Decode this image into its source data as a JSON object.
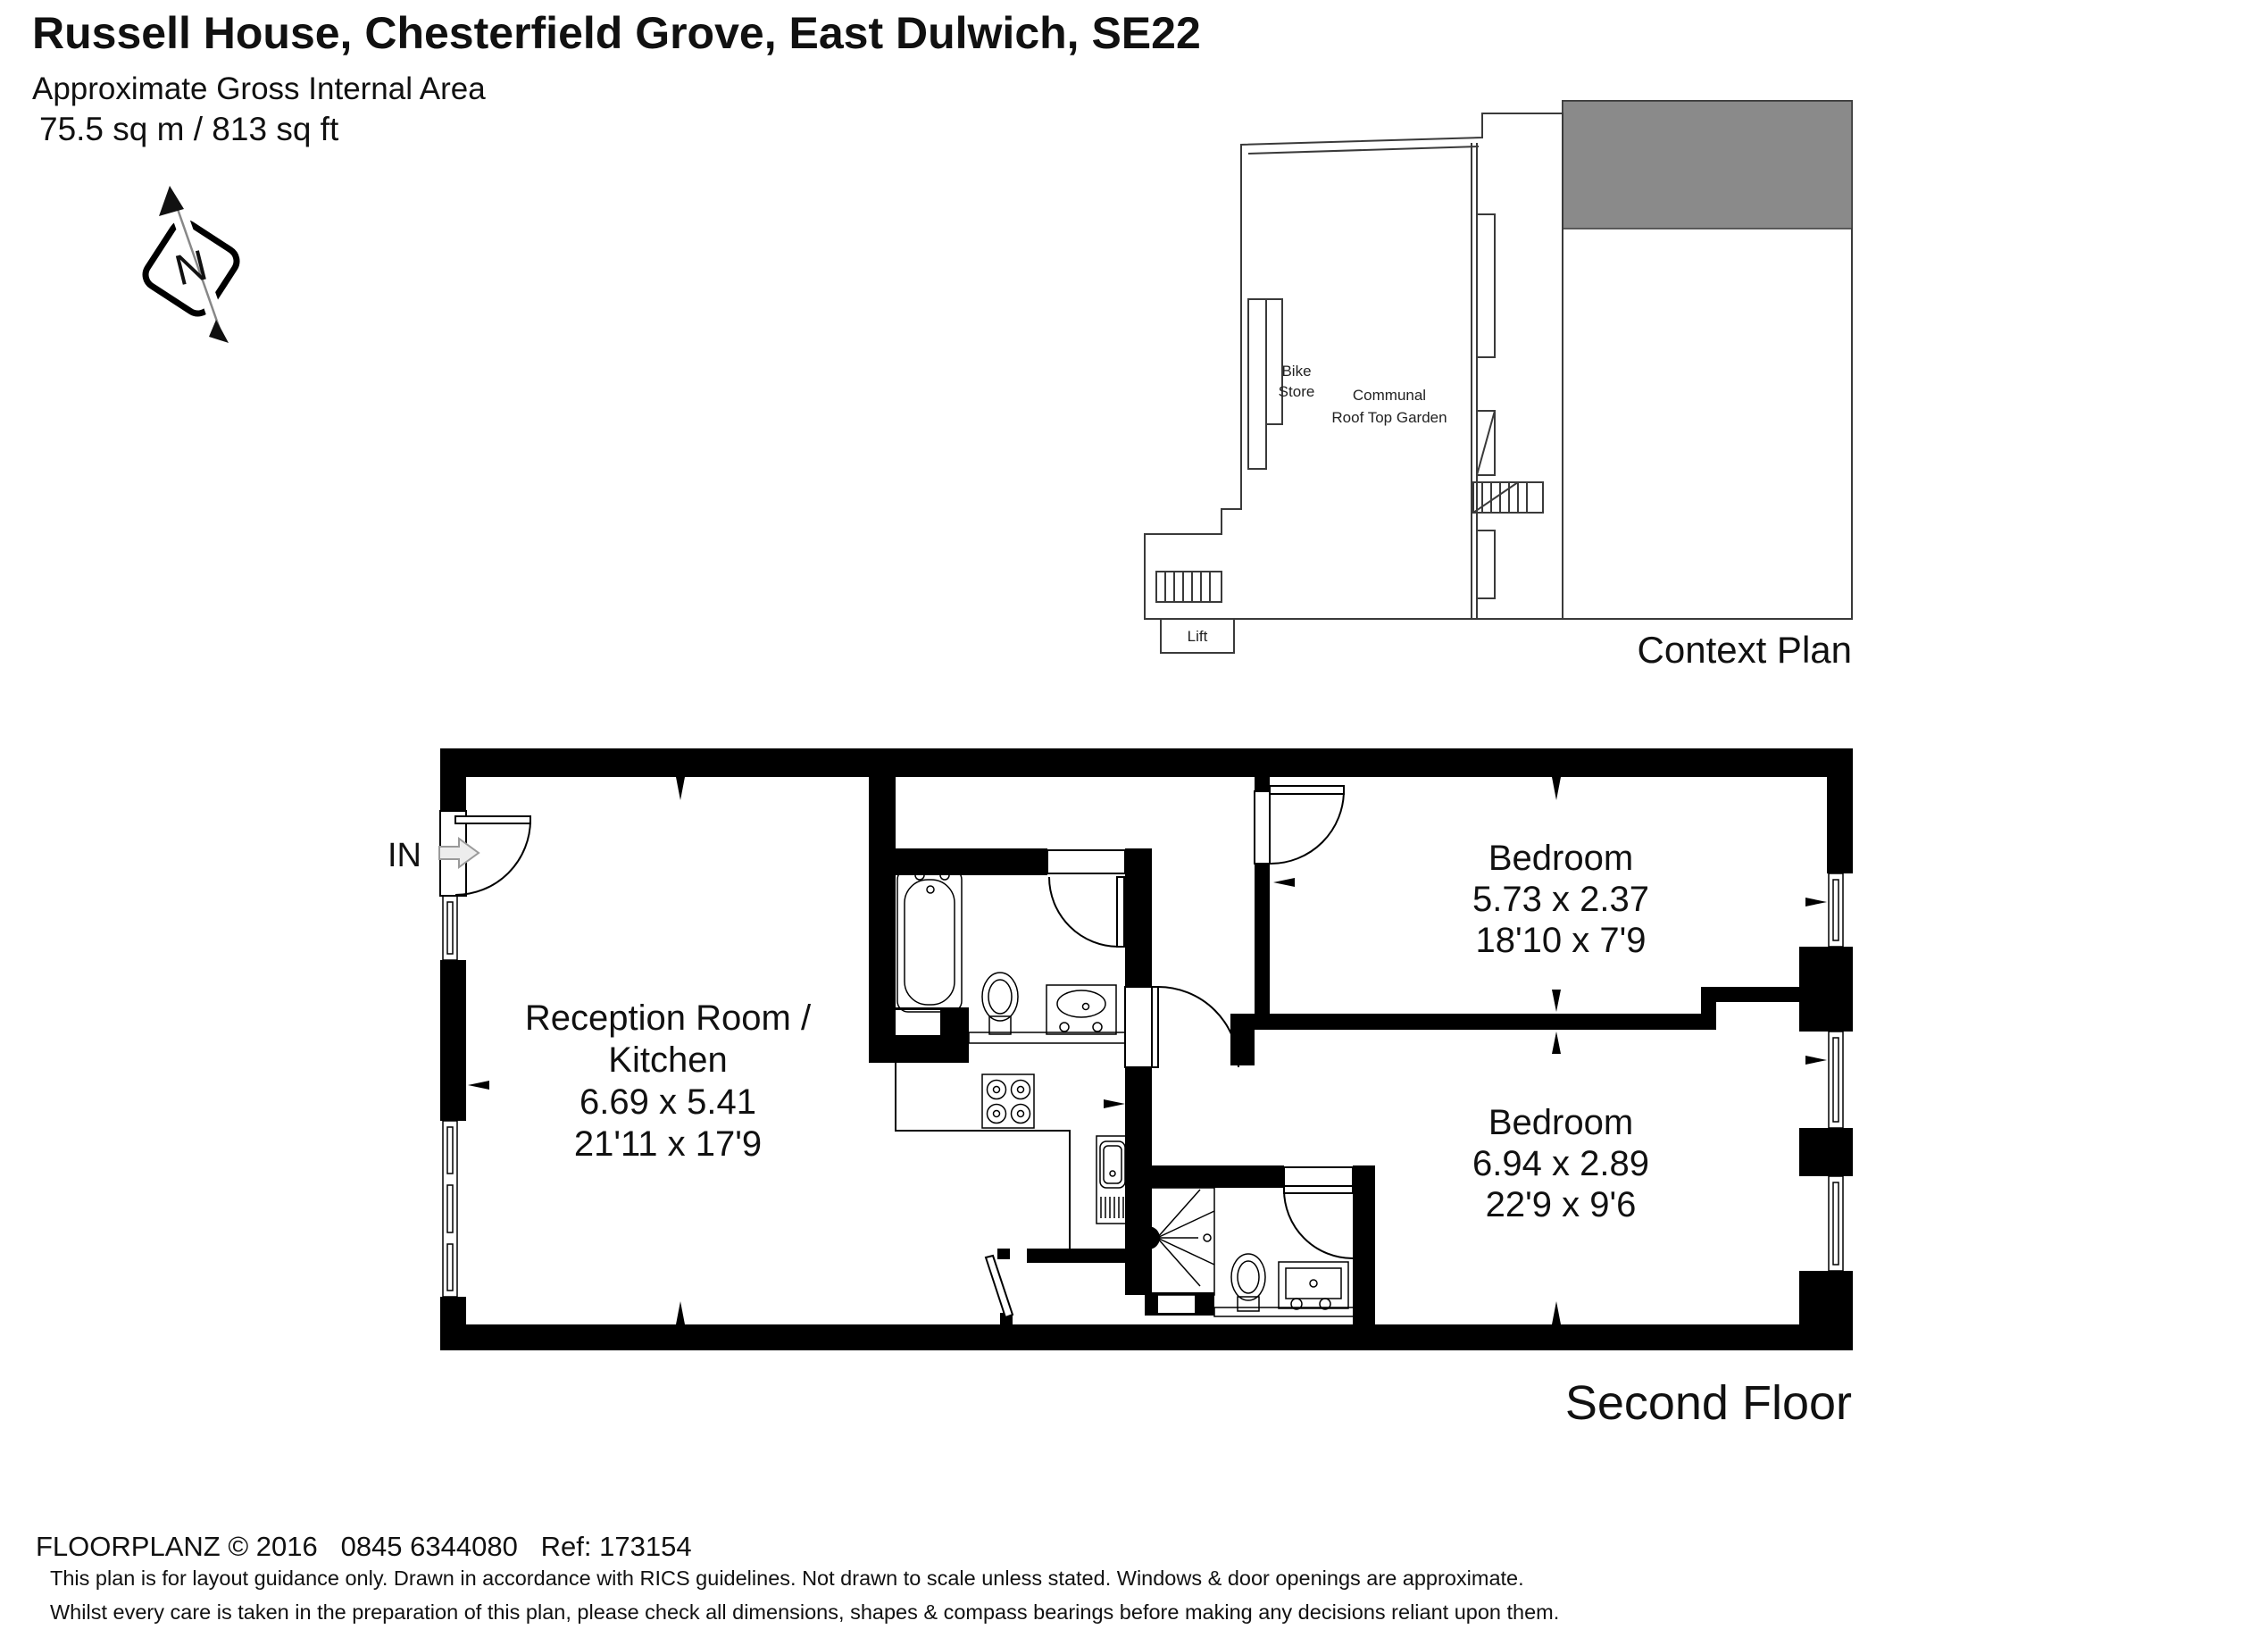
{
  "header": {
    "title": "Russell House, Chesterfield Grove, East Dulwich, SE22",
    "subtitle": "Approximate Gross Internal Area",
    "area": "75.5 sq m / 813 sq ft"
  },
  "compass": {
    "label": "N"
  },
  "context_plan": {
    "caption": "Context Plan",
    "bike_store_line1": "Bike",
    "bike_store_line2": "Store",
    "garden_line1": "Communal",
    "garden_line2": "Roof Top Garden",
    "lift": "Lift",
    "highlight_color": "#8a8a8a"
  },
  "floor": {
    "caption": "Second Floor",
    "entrance_label": "IN",
    "rooms": {
      "reception": {
        "name_line1": "Reception Room /",
        "name_line2": "Kitchen",
        "metric": "6.69 x 5.41",
        "imperial": "21'11 x 17'9"
      },
      "bedroom1": {
        "name": "Bedroom",
        "metric": "5.73 x 2.37",
        "imperial": "18'10 x 7'9"
      },
      "bedroom2": {
        "name": "Bedroom",
        "metric": "6.94 x 2.89",
        "imperial": "22'9 x 9'6"
      }
    }
  },
  "footer": {
    "copyright": "FLOORPLANZ © 2016   0845 6344080   Ref: 173154",
    "disclaimer_line1": "This plan is for layout guidance only. Drawn in accordance with RICS guidelines. Not drawn to scale unless stated. Windows & door openings are approximate.",
    "disclaimer_line2": "Whilst every care is taken in the preparation of this plan, please check all dimensions, shapes & compass bearings before making any decisions reliant upon them."
  }
}
